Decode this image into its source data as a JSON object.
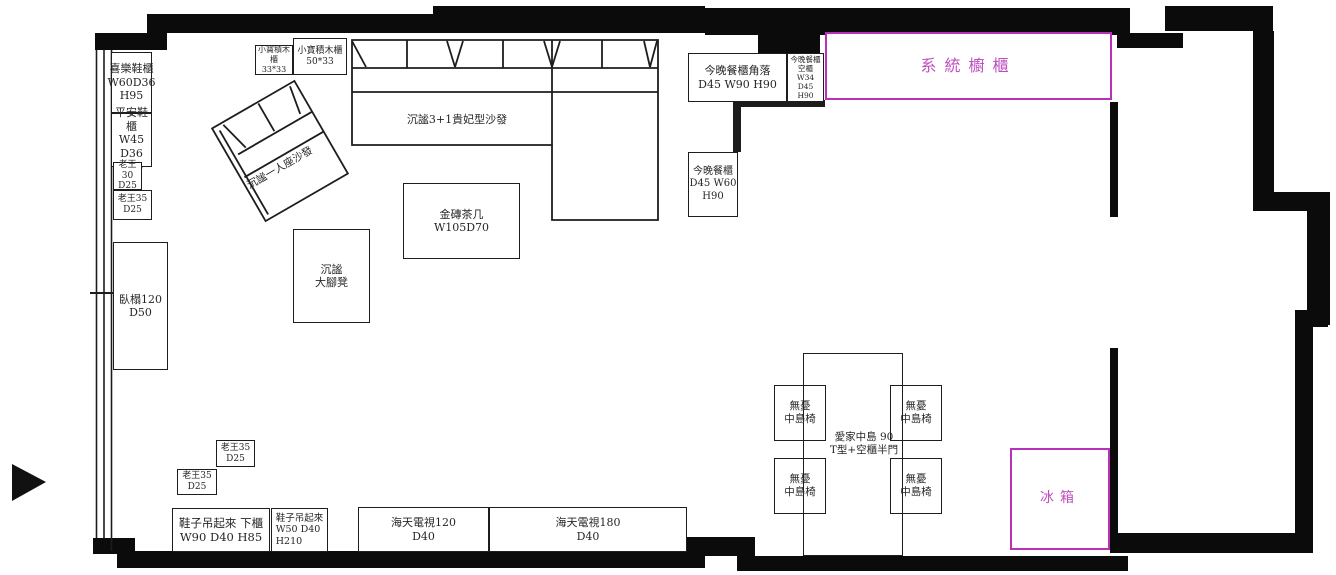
{
  "title": "室內傢俱配置平面圖",
  "colors": {
    "magenta_border": "#b832b8",
    "magenta_text": "#bf4fbf",
    "line": "#1d1d1d",
    "wall": "#0b0b0b"
  },
  "furniture": {
    "xile_cabinet": {
      "label": "喜樂鞋櫃\nW60D36\nH95"
    },
    "pingan_cabinet": {
      "label": "平安鞋櫃\nW45 D36\nH75"
    },
    "laowang30": {
      "label": "老王30\nD25"
    },
    "laowang35_left": {
      "label": "老王35\nD25"
    },
    "daybed": {
      "label": "臥榻120\nD50"
    },
    "blocks_cabinet_33": {
      "label": "小寶積木櫃\n33*33"
    },
    "blocks_cabinet_50": {
      "label": "小寶積木櫃\n50*33"
    },
    "sofa_31": {
      "label": "沉謐3+1貴妃型沙發"
    },
    "sofa_single": {
      "label": "沉謐一人座沙發"
    },
    "coffee_table": {
      "label": "金磚茶几\nW105D70"
    },
    "footstool": {
      "label": "沉謐\n大腳凳"
    },
    "dining_corner_cabinet": {
      "label": "今晚餐櫃角落\nD45 W90 H90"
    },
    "dining_empty_cabinet": {
      "label": "今晚餐櫃\n空櫃\nW34 D45\nH90"
    },
    "dining_cabinet": {
      "label": "今晚餐櫃\nD45 W60\nH90"
    },
    "system_cabinet": {
      "label": "系統櫥櫃"
    },
    "fridge": {
      "label": "冰箱"
    },
    "island": {
      "label": "愛家中島 90\nT型+空櫃半門"
    },
    "chair": {
      "label": "無憂\n中島椅"
    },
    "laowang35_b1": {
      "label": "老王35\nD25"
    },
    "laowang35_b2": {
      "label": "老王35\nD25"
    },
    "shoe_hang_lower": {
      "label": "鞋子吊起來 下櫃\nW90 D40 H85"
    },
    "shoe_hang_tall": {
      "label": "鞋子吊起來\nW50 D40\nH210"
    },
    "tv120": {
      "label": "海天電視120\nD40"
    },
    "tv180": {
      "label": "海天電視180\nD40"
    }
  }
}
